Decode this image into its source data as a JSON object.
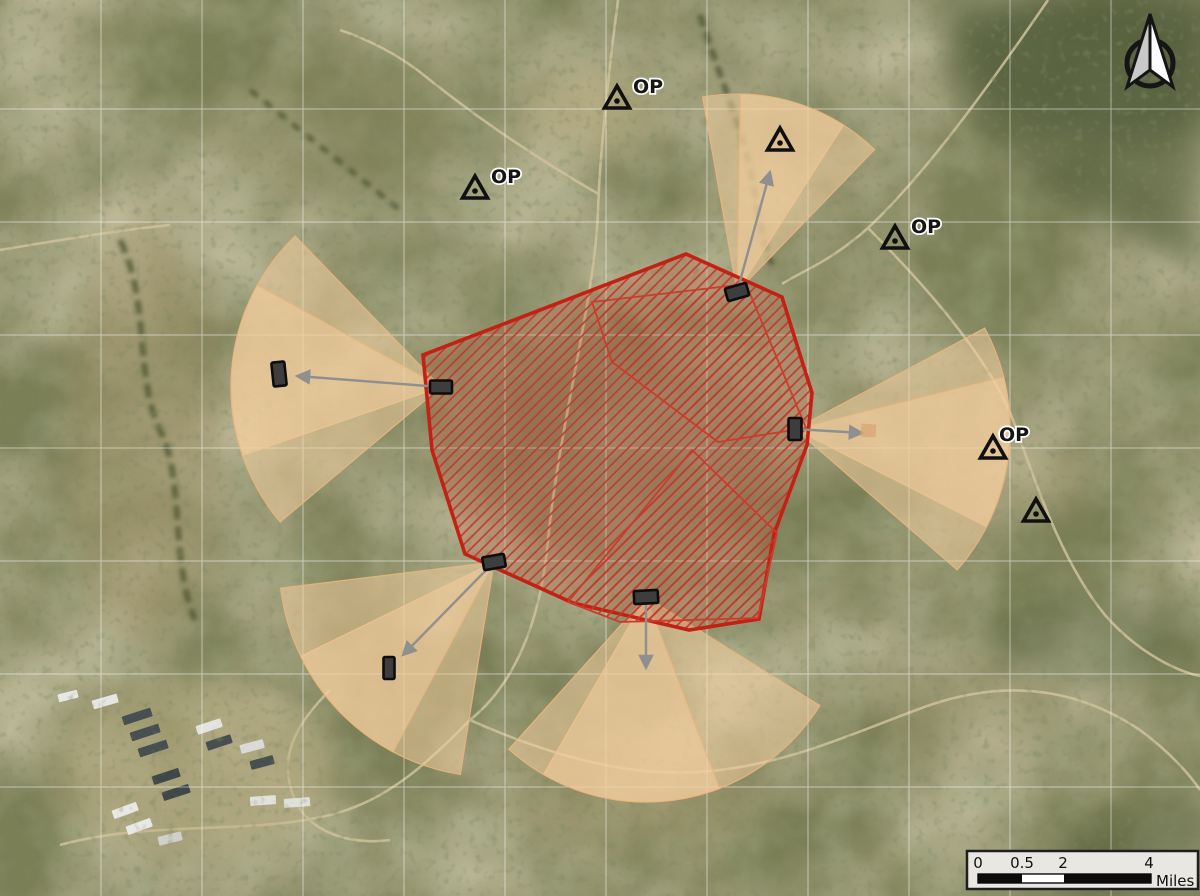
{
  "observation_posts": [
    {
      "label": "OP"
    },
    {
      "label": "OP"
    },
    {
      "label": "OP"
    },
    {
      "label": "OP"
    }
  ],
  "scale_bar": {
    "ticks": [
      "0",
      "0.5",
      "2",
      "4"
    ],
    "unit_label": "Miles"
  },
  "colors": {
    "impact_outline": "#c32114",
    "impact_hatch": "#c23a2a",
    "impact_wash": "rgba(205,85,65,0.24)",
    "fan_fill": "#f6cf9f",
    "fan_edge": "#eab57e",
    "grid_line": "#ffffff",
    "arrow": "#8f8f8f",
    "marker_fill": "#3d3d3d"
  }
}
